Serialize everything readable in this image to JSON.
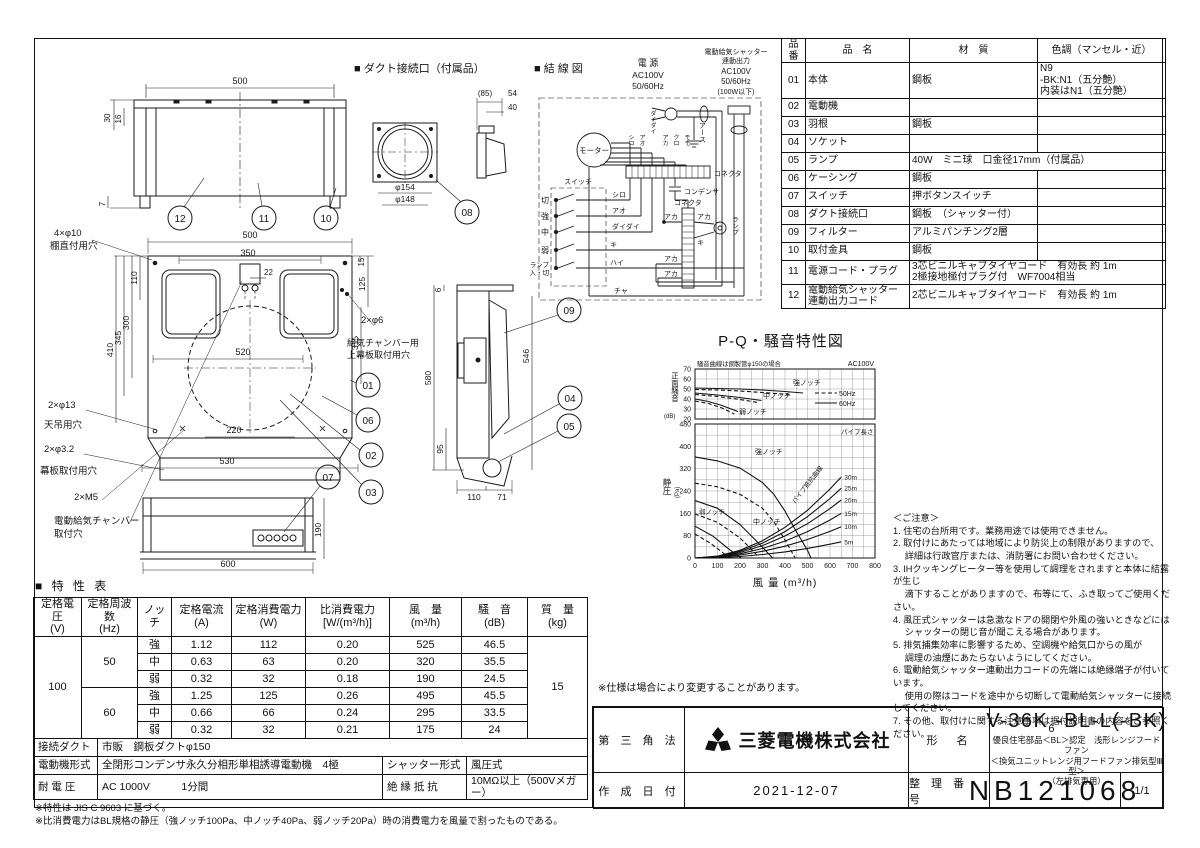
{
  "misc": {
    "spec_note": "※仕様は場合により変更することがあります。"
  },
  "drawings": {
    "headers": {
      "duct": "■ ダクト接続口（付属品）",
      "wiring": "■ 結 線 図"
    },
    "dims": {
      "tv500": "500",
      "tv30": "30",
      "tv16": "16",
      "tv7": "7",
      "dc85": "(85)",
      "dc54": "54",
      "dc40": "40",
      "dc154": "φ154",
      "dc148": "φ148",
      "fv500": "500",
      "fv350": "350",
      "fv22": "22",
      "fv110": "110",
      "fv300": "300",
      "fv345": "345",
      "fv410": "410",
      "fv520": "520",
      "fv15": "15",
      "fv125": "125",
      "fv315": "315",
      "fv220": "220",
      "fv530": "530",
      "sv6": "6",
      "sv580": "580",
      "sv546": "546",
      "sv95": "95",
      "sv110": "110",
      "sv71": "71",
      "bv600": "600",
      "bv190": "190"
    },
    "holes": {
      "shelf1": "4×φ10",
      "shelf2": "棚直付用穴",
      "ceil1": "2×φ13",
      "ceil2": "天吊用穴",
      "band1": "2×φ3.2",
      "band2": "幕板取付用穴",
      "m5": "2×M5",
      "chamber1": "電動給気チャンバー",
      "chamber2": "取付穴",
      "supply1": "2×φ6",
      "supply2": "給気チャンバー用",
      "supply3": "上幕板取付用穴"
    },
    "callouts": {
      "c01": "01",
      "c02": "02",
      "c03": "03",
      "c04": "04",
      "c05": "05",
      "c06": "06",
      "c07": "07",
      "c08": "08",
      "c09": "09",
      "c10": "10",
      "c11": "11",
      "c12": "12"
    },
    "wiring": {
      "power": "電 源",
      "ac": "AC100V",
      "hz": "50/60Hz",
      "shutter1": "電動給気シャッター",
      "shutter2": "連動出力",
      "shutter3": "AC100V",
      "shutter4": "50/60Hz",
      "shutter5": "(100W以下)",
      "earth": "アース",
      "motor": "モーター",
      "switch": "スイッチ",
      "sw_off": "切",
      "sw_hi": "強",
      "sw_mid": "中",
      "sw_low": "弱",
      "sw_lamp1": "ランプ",
      "sw_lamp2": "入・切",
      "w_shiro": "シロ",
      "w_ao": "アオ",
      "w_daidai": "ダイダイ",
      "w_ki": "キ",
      "w_hai": "ハイ",
      "w_cha": "チャ",
      "w_aka": "アカ",
      "w_kuro": "クロ",
      "w_momo": "モモ",
      "connector": "コネクタ",
      "condenser": "コンデンサ",
      "lamp": "ランプ"
    }
  },
  "parts_table": {
    "rows": [
      [
        {
          "t": "品番",
          "h": 1
        },
        {
          "t": "品　名",
          "h": 1
        },
        {
          "t": "材　質",
          "h": 1
        },
        {
          "t": "色調（マンセル・近）",
          "h": 1
        }
      ],
      [
        {
          "t": "01"
        },
        {
          "t": "本体",
          "cls": "tl"
        },
        {
          "t": "鋼板",
          "cls": "tl"
        },
        {
          "t": "N9\n-BK:N1（五分艶）\n内装はN1（五分艶）",
          "cls": "tl"
        }
      ],
      [
        {
          "t": "02"
        },
        {
          "t": "電動機",
          "cls": "tl"
        },
        {
          "t": ""
        },
        {
          "t": ""
        }
      ],
      [
        {
          "t": "03"
        },
        {
          "t": "羽根",
          "cls": "tl"
        },
        {
          "t": "鋼板",
          "cls": "tl"
        },
        {
          "t": ""
        }
      ],
      [
        {
          "t": "04"
        },
        {
          "t": "ソケット",
          "cls": "tl"
        },
        {
          "t": ""
        },
        {
          "t": ""
        }
      ],
      [
        {
          "t": "05"
        },
        {
          "t": "ランプ",
          "cls": "tl"
        },
        {
          "t": "40W　ミニ球　口金径17mm（付属品）",
          "cls": "tl",
          "cs": 2
        }
      ],
      [
        {
          "t": "06"
        },
        {
          "t": "ケーシング",
          "cls": "tl"
        },
        {
          "t": "鋼板",
          "cls": "tl"
        },
        {
          "t": ""
        }
      ],
      [
        {
          "t": "07"
        },
        {
          "t": "スイッチ",
          "cls": "tl"
        },
        {
          "t": "押ボタンスイッチ",
          "cls": "tl"
        },
        {
          "t": ""
        }
      ],
      [
        {
          "t": "08"
        },
        {
          "t": "ダクト接続口",
          "cls": "tl"
        },
        {
          "t": "鋼板　（シャッター付）",
          "cls": "tl"
        },
        {
          "t": ""
        }
      ],
      [
        {
          "t": "09"
        },
        {
          "t": "フィルター",
          "cls": "tl"
        },
        {
          "t": "アルミパンチング2層",
          "cls": "tl"
        },
        {
          "t": ""
        }
      ],
      [
        {
          "t": "10"
        },
        {
          "t": "取付金具",
          "cls": "tl"
        },
        {
          "t": "鋼板",
          "cls": "tl"
        },
        {
          "t": ""
        }
      ],
      [
        {
          "t": "11"
        },
        {
          "t": "電源コード・プラグ",
          "cls": "tl"
        },
        {
          "t": "3芯ビニルキャブタイヤコード　有効長 約 1m\n2極接地極付プラグ付　WF7004相当",
          "cls": "tl",
          "cs": 2
        }
      ],
      [
        {
          "t": "12"
        },
        {
          "t": "電動給気シャッター\n連動出力コード",
          "cls": "tl"
        },
        {
          "t": "2芯ビニルキャブタイヤコード　有効長 約 1m",
          "cls": "tl",
          "cs": 2
        }
      ]
    ]
  },
  "char_table": {
    "title": "■ 特 性 表",
    "rows": [
      [
        {
          "t": "定格電圧\n(V)",
          "h": 1
        },
        {
          "t": "定格周波数\n(Hz)",
          "h": 1
        },
        {
          "t": "ノッチ",
          "h": 1
        },
        {
          "t": "定格電流\n(A)",
          "h": 1
        },
        {
          "t": "定格消費電力\n(W)",
          "h": 1
        },
        {
          "t": "比消費電力\n[W/(m³/h)]",
          "h": 1
        },
        {
          "t": "風　量\n(m³/h)",
          "h": 1
        },
        {
          "t": "騒　音\n(dB)",
          "h": 1
        },
        {
          "t": "質　量\n(kg)",
          "h": 1
        }
      ],
      [
        {
          "t": "100",
          "rs": 6
        },
        {
          "t": "50",
          "rs": 3
        },
        {
          "t": "強"
        },
        {
          "t": "1.12"
        },
        {
          "t": "112"
        },
        {
          "t": "0.20"
        },
        {
          "t": "525"
        },
        {
          "t": "46.5"
        },
        {
          "t": "15",
          "rs": 6
        }
      ],
      [
        {
          "t": "中"
        },
        {
          "t": "0.63"
        },
        {
          "t": "63"
        },
        {
          "t": "0.20"
        },
        {
          "t": "320"
        },
        {
          "t": "35.5"
        }
      ],
      [
        {
          "t": "弱"
        },
        {
          "t": "0.32"
        },
        {
          "t": "32"
        },
        {
          "t": "0.18"
        },
        {
          "t": "190"
        },
        {
          "t": "24.5"
        }
      ],
      [
        {
          "t": "60",
          "rs": 3
        },
        {
          "t": "強"
        },
        {
          "t": "1.25"
        },
        {
          "t": "125"
        },
        {
          "t": "0.26"
        },
        {
          "t": "495"
        },
        {
          "t": "45.5"
        }
      ],
      [
        {
          "t": "中"
        },
        {
          "t": "0.66"
        },
        {
          "t": "66"
        },
        {
          "t": "0.24"
        },
        {
          "t": "295"
        },
        {
          "t": "33.5"
        }
      ],
      [
        {
          "t": "弱"
        },
        {
          "t": "0.32"
        },
        {
          "t": "32"
        },
        {
          "t": "0.21"
        },
        {
          "t": "175"
        },
        {
          "t": "24"
        }
      ]
    ],
    "sub_rows": [
      [
        {
          "t": "接続ダクト"
        },
        {
          "t": "市販　鋼板ダクトφ150",
          "cs": 3,
          "cls": "tl"
        }
      ],
      [
        {
          "t": "電動機形式"
        },
        {
          "t": "全閉形コンデンサ永久分相形単相誘導電動機　4極",
          "cls": "tl"
        },
        {
          "t": "シャッター形式"
        },
        {
          "t": "風圧式",
          "cls": "tl"
        }
      ],
      [
        {
          "t": "耐 電 圧"
        },
        {
          "t": "AC 1000V　　　1分間",
          "cls": "tl"
        },
        {
          "t": "絶 縁 抵 抗"
        },
        {
          "t": "10MΩ以上（500Vメガー）",
          "cls": "tl"
        }
      ]
    ],
    "footnotes": [
      "※特性は JIS C 9603 に基づく。",
      "※比消費電力はBL規格の静圧（強ノッチ100Pa、中ノッチ40Pa、弱ノッチ20Pa）時の消費電力を風量で割ったものである。"
    ]
  },
  "notes": {
    "title": "＜ご注意＞",
    "lines": [
      "1. 住宅の台所用です。業務用途では使用できません。",
      "2. 取付けにあたっては地域により防災上の制限がありますので、",
      "　 詳細は行政官庁または、消防署にお問い合わせください。",
      "3. IHクッキングヒーター等を使用して調理をされますと本体に結露が生じ",
      "　 滴下することがありますので、布等にて、ふき取ってご使用ください。",
      "4. 風圧式シャッターは急激なドアの開閉や外風の強いときなどには",
      "　 シャッターの閉じ音が聞こえる場合があります。",
      "5. 排気捕集効率に影響するため、空調機や給気口からの風が",
      "　 調理の油煙にあたらないようにしてください。",
      "6. 電動給気シャッター連動出力コードの先端には絶縁端子が付いています。",
      "　 使用の際はコードを途中から切断して電動給気シャッターに接続してください。",
      "7. その他、取付けに関する注意事項は据付説明書の内容をご参照ください。"
    ]
  },
  "title_block": {
    "projection": "第 三 角 法",
    "company": "三菱電機株式会社",
    "model_label": "形　名",
    "model_prefix": "V-36K",
    "model_sub": "6",
    "model_suffix": "-BL-L(-BK)",
    "model_desc1": "優良住宅部品＜BL＞認定　浅形レンジフードファン",
    "model_desc2": "＜換気ユニットレンジ用フードファン排気型Ⅲ型＞",
    "model_desc3": "（左排気専用）",
    "date_label": "作 成 日 付",
    "date": "2021-12-07",
    "number_label": "整 理 番 号",
    "number": "NB121068",
    "page": "1/1"
  },
  "chart_data": {
    "type": "line",
    "title": "P-Q・騒音特性図",
    "note": "騒音曲線は鋼製管φ150の場合",
    "voltage": "AC100V",
    "xlabel": "風 量 (m³/h)",
    "x_ticks": [
      0,
      100,
      200,
      300,
      400,
      500,
      600,
      700,
      800
    ],
    "xlim": [
      0,
      800
    ],
    "legend": [
      {
        "label": "50Hz",
        "style": "dashed"
      },
      {
        "label": "60Hz",
        "style": "solid"
      }
    ],
    "curve_labels": {
      "hi": "強ノッチ",
      "mid": "中ノッチ",
      "low": "弱ノッチ"
    },
    "noise": {
      "ylabel": "正面騒音",
      "yunit": "(dB)",
      "ylim": [
        20,
        70
      ],
      "yticks": [
        20,
        30,
        40,
        50,
        60,
        70
      ],
      "series": [
        {
          "name": "強ノッチ60Hz",
          "style": "solid",
          "points": [
            [
              0,
              51
            ],
            [
              100,
              50.5
            ],
            [
              200,
              50
            ],
            [
              300,
              49
            ],
            [
              400,
              47.5
            ],
            [
              480,
              46
            ]
          ]
        },
        {
          "name": "強ノッチ50Hz",
          "style": "dashed",
          "points": [
            [
              0,
              49.5
            ],
            [
              100,
              49
            ],
            [
              200,
              48
            ],
            [
              300,
              46.5
            ],
            [
              420,
              44.5
            ]
          ]
        },
        {
          "name": "中ノッチ60Hz",
          "style": "solid",
          "points": [
            [
              0,
              46
            ],
            [
              100,
              44
            ],
            [
              200,
              41.5
            ],
            [
              295,
              38.5
            ]
          ]
        },
        {
          "name": "中ノッチ50Hz",
          "style": "dashed",
          "points": [
            [
              0,
              44.5
            ],
            [
              100,
              42.5
            ],
            [
              200,
              39.5
            ],
            [
              280,
              36.5
            ]
          ]
        },
        {
          "name": "弱ノッチ60Hz",
          "style": "solid",
          "points": [
            [
              0,
              40
            ],
            [
              60,
              37.5
            ],
            [
              120,
              33.5
            ],
            [
              190,
              27.5
            ]
          ]
        },
        {
          "name": "弱ノッチ50Hz",
          "style": "dashed",
          "points": [
            [
              0,
              38
            ],
            [
              60,
              35.5
            ],
            [
              120,
              31
            ],
            [
              175,
              25
            ]
          ]
        }
      ]
    },
    "pq": {
      "ylabel": "静圧",
      "yunit": "(Pa)",
      "ylim": [
        0,
        480
      ],
      "yticks": [
        0,
        80,
        160,
        240,
        320,
        400,
        480
      ],
      "pipe_label": "パイプ長さ",
      "pipe_curve_label": "パイプ抵抗曲線",
      "series": [
        {
          "name": "強ノッチ60Hz",
          "style": "solid",
          "points": [
            [
              0,
              362
            ],
            [
              100,
              348
            ],
            [
              200,
              322
            ],
            [
              300,
              270
            ],
            [
              350,
              228
            ],
            [
              400,
              168
            ],
            [
              450,
              95
            ],
            [
              500,
              28
            ],
            [
              515,
              0
            ]
          ]
        },
        {
          "name": "強ノッチ50Hz",
          "style": "dashed",
          "points": [
            [
              0,
              268
            ],
            [
              100,
              255
            ],
            [
              200,
              228
            ],
            [
              300,
              178
            ],
            [
              350,
              130
            ],
            [
              400,
              65
            ],
            [
              445,
              0
            ]
          ]
        },
        {
          "name": "中ノッチ60Hz",
          "style": "solid",
          "points": [
            [
              0,
              206
            ],
            [
              100,
              178
            ],
            [
              200,
              120
            ],
            [
              280,
              55
            ],
            [
              345,
              0
            ]
          ]
        },
        {
          "name": "中ノッチ50Hz",
          "style": "dashed",
          "points": [
            [
              0,
              158
            ],
            [
              100,
              128
            ],
            [
              200,
              72
            ],
            [
              270,
              15
            ],
            [
              282,
              0
            ]
          ]
        },
        {
          "name": "弱ノッチ60Hz",
          "style": "solid",
          "points": [
            [
              0,
              114
            ],
            [
              80,
              78
            ],
            [
              150,
              32
            ],
            [
              205,
              0
            ]
          ]
        },
        {
          "name": "弱ノッチ50Hz",
          "style": "dashed",
          "points": [
            [
              0,
              86
            ],
            [
              70,
              52
            ],
            [
              130,
              15
            ],
            [
              162,
              0
            ]
          ]
        }
      ],
      "pipe_series": [
        {
          "name": "30m",
          "points": [
            [
              0,
              0
            ],
            [
              100,
              6.9
            ],
            [
              200,
              27.5
            ],
            [
              300,
              61.8
            ],
            [
              400,
              110
            ],
            [
              500,
              171
            ],
            [
              600,
              247
            ],
            [
              650,
              290
            ]
          ]
        },
        {
          "name": "25m",
          "points": [
            [
              0,
              0
            ],
            [
              100,
              5.9
            ],
            [
              200,
              23.7
            ],
            [
              300,
              53.3
            ],
            [
              400,
              94.7
            ],
            [
              500,
              148
            ],
            [
              600,
              213
            ],
            [
              650,
              250
            ]
          ]
        },
        {
          "name": "20m",
          "points": [
            [
              0,
              0
            ],
            [
              100,
              4.9
            ],
            [
              200,
              19.7
            ],
            [
              300,
              44.3
            ],
            [
              400,
              78.8
            ],
            [
              500,
              123
            ],
            [
              600,
              177
            ],
            [
              650,
              208
            ]
          ]
        },
        {
          "name": "15m",
          "points": [
            [
              0,
              0
            ],
            [
              100,
              3.8
            ],
            [
              200,
              15.1
            ],
            [
              300,
              34.1
            ],
            [
              400,
              60.6
            ],
            [
              500,
              94.7
            ],
            [
              600,
              136
            ],
            [
              650,
              160
            ]
          ]
        },
        {
          "name": "10m",
          "points": [
            [
              0,
              0
            ],
            [
              100,
              2.7
            ],
            [
              200,
              10.6
            ],
            [
              300,
              23.9
            ],
            [
              400,
              42.4
            ],
            [
              500,
              66.3
            ],
            [
              600,
              95.4
            ],
            [
              650,
              112
            ]
          ]
        },
        {
          "name": "5m",
          "points": [
            [
              0,
              0
            ],
            [
              100,
              1.4
            ],
            [
              200,
              5.5
            ],
            [
              300,
              12.4
            ],
            [
              400,
              22
            ],
            [
              500,
              34.3
            ],
            [
              600,
              49.4
            ],
            [
              650,
              58
            ]
          ]
        }
      ]
    }
  }
}
